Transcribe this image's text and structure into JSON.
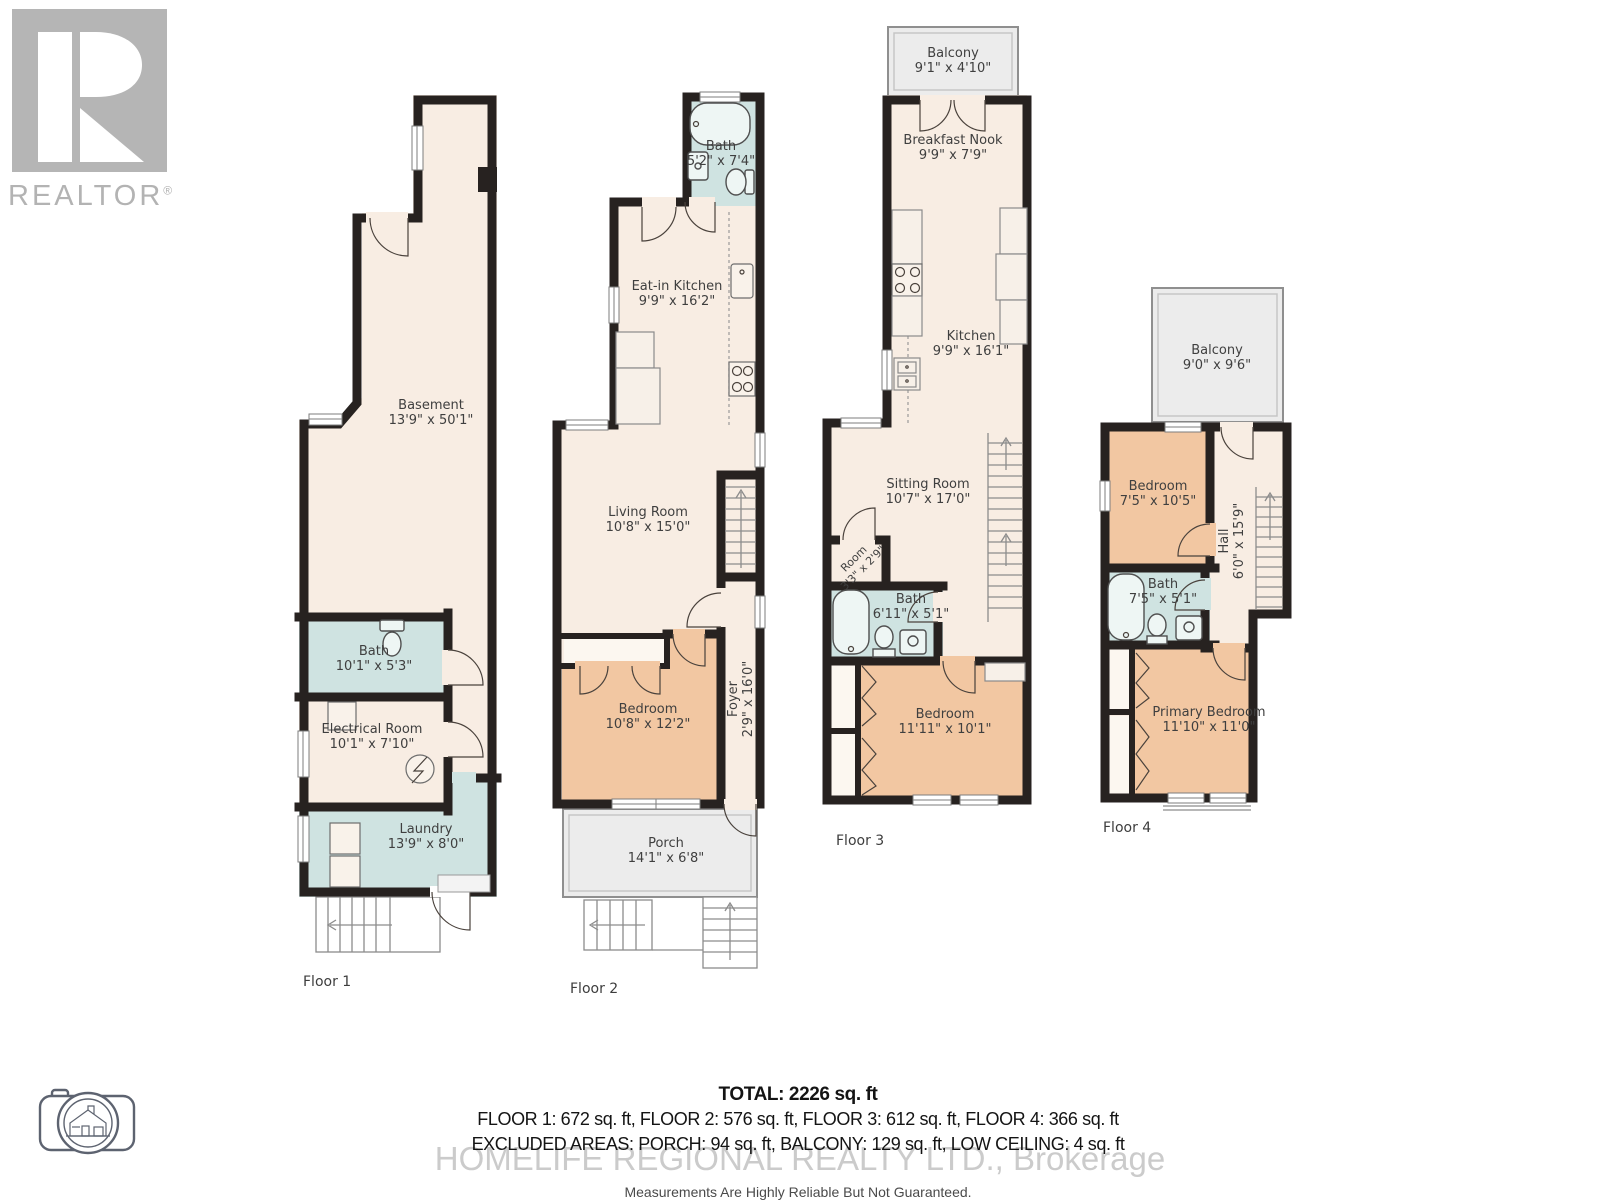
{
  "colors": {
    "wall": "#272220",
    "floor": "#f8ede3",
    "bedroom": "#f2c7a2",
    "bath": "#cfe3e1",
    "outdoor": "#ececec",
    "label_text": "#3f3f3f",
    "logo_gray": "#b3b3b3"
  },
  "branding": {
    "realtor_wordmark": "REALTOR",
    "registered_symbol": "®"
  },
  "floors": [
    {
      "label": "Floor 1",
      "rooms": {
        "basement": {
          "name": "Basement",
          "dims": "13'9\" x 50'1\""
        },
        "bath": {
          "name": "Bath",
          "dims": "10'1\" x 5'3\""
        },
        "electrical": {
          "name": "Electrical Room",
          "dims": "10'1\" x 7'10\""
        },
        "laundry": {
          "name": "Laundry",
          "dims": "13'9\" x 8'0\""
        }
      }
    },
    {
      "label": "Floor 2",
      "rooms": {
        "bath": {
          "name": "Bath",
          "dims": "5'2\" x 7'4\""
        },
        "kitchen": {
          "name": "Eat-in Kitchen",
          "dims": "9'9\" x 16'2\""
        },
        "living": {
          "name": "Living Room",
          "dims": "10'8\" x 15'0\""
        },
        "bedroom": {
          "name": "Bedroom",
          "dims": "10'8\" x 12'2\""
        },
        "foyer": {
          "name": "Foyer",
          "dims": "2'9\" x 16'0\""
        },
        "porch": {
          "name": "Porch",
          "dims": "14'1\" x 6'8\""
        }
      }
    },
    {
      "label": "Floor 3",
      "rooms": {
        "balcony": {
          "name": "Balcony",
          "dims": "9'1\" x 4'10\""
        },
        "nook": {
          "name": "Breakfast Nook",
          "dims": "9'9\" x 7'9\""
        },
        "kitchen": {
          "name": "Kitchen",
          "dims": "9'9\" x 16'1\""
        },
        "sitting": {
          "name": "Sitting Room",
          "dims": "10'7\" x 17'0\""
        },
        "room": {
          "name": "Room",
          "dims": "3'3\" x 2'9\""
        },
        "bath": {
          "name": "Bath",
          "dims": "6'11\" x 5'1\""
        },
        "bedroom": {
          "name": "Bedroom",
          "dims": "11'11\" x 10'1\""
        }
      }
    },
    {
      "label": "Floor 4",
      "rooms": {
        "balcony": {
          "name": "Balcony",
          "dims": "9'0\" x 9'6\""
        },
        "bedroom": {
          "name": "Bedroom",
          "dims": "7'5\" x 10'5\""
        },
        "hall": {
          "name": "Hall",
          "dims": "6'0\" x 15'9\""
        },
        "bath": {
          "name": "Bath",
          "dims": "7'5\" x 5'1\""
        },
        "primary": {
          "name": "Primary Bedroom",
          "dims": "11'10\" x 11'0\""
        }
      }
    }
  ],
  "summary": {
    "total": "TOTAL: 2226 sq. ft",
    "floor_areas": "FLOOR 1: 672 sq. ft, FLOOR 2: 576 sq. ft, FLOOR 3: 612 sq. ft, FLOOR 4: 366 sq. ft",
    "excluded": "EXCLUDED AREAS: PORCH: 94 sq. ft, BALCONY: 129 sq. ft, LOW CEILING: 4 sq. ft",
    "watermark": "HOMELIFE REGIONAL REALTY LTD., Brokerage",
    "disclaimer": "Measurements Are Highly Reliable But Not Guaranteed."
  }
}
